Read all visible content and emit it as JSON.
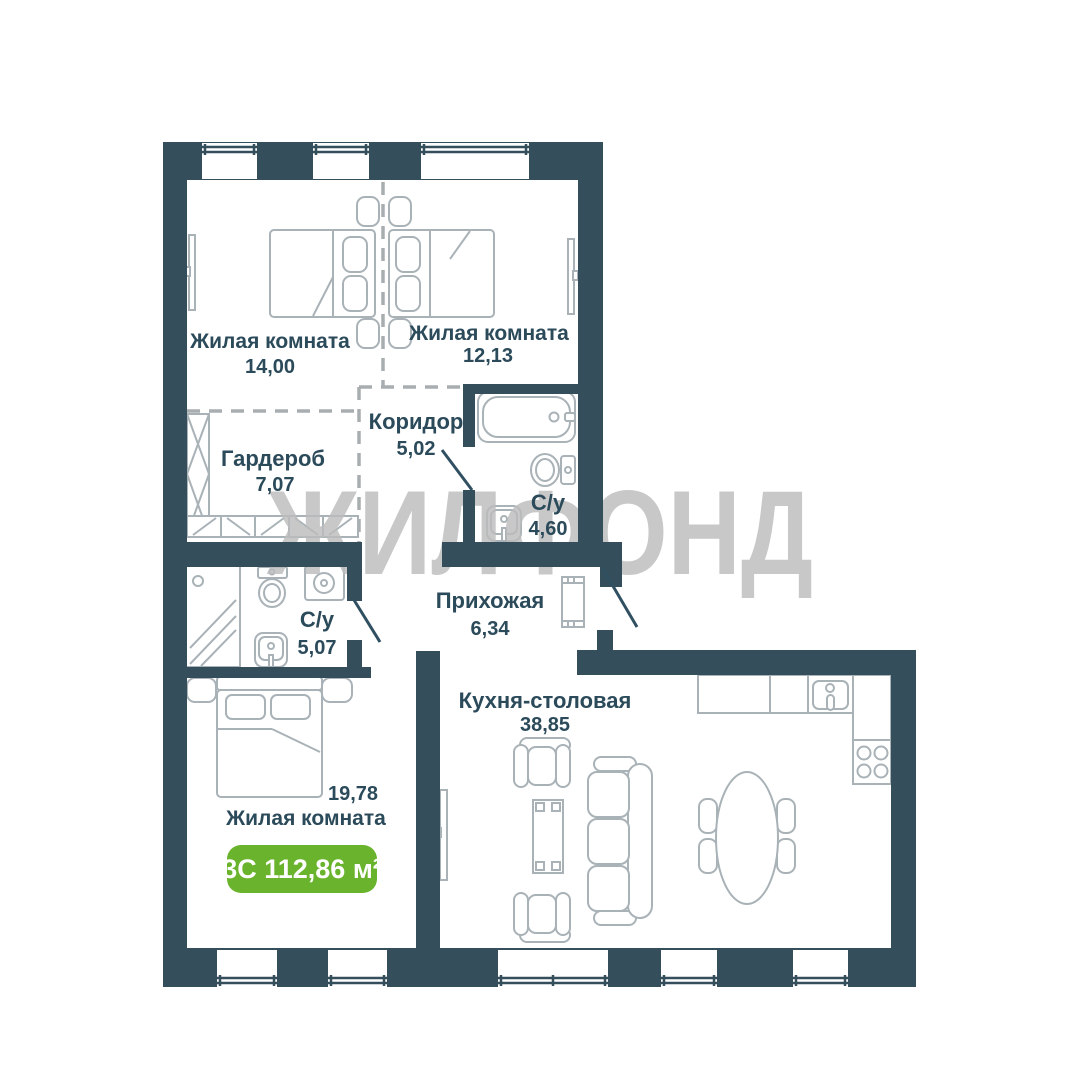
{
  "plan": {
    "watermark": "ЖИЛФОНД",
    "badge": {
      "label": "3С 112,86 м²",
      "color": "#6ab32d"
    },
    "rooms": [
      {
        "id": "living-room-1",
        "name": "Жилая комната",
        "area": "14,00"
      },
      {
        "id": "living-room-2",
        "name": "Жилая комната",
        "area": "12,13"
      },
      {
        "id": "corridor",
        "name": "Коридор",
        "area": "5,02"
      },
      {
        "id": "wardrobe",
        "name": "Гардероб",
        "area": "7,07"
      },
      {
        "id": "bathroom-1",
        "name": "С/у",
        "area": "4,60"
      },
      {
        "id": "bathroom-2",
        "name": "С/у",
        "area": "5,07"
      },
      {
        "id": "hallway",
        "name": "Прихожая",
        "area": "6,34"
      },
      {
        "id": "kitchen-dining",
        "name": "Кухня-столовая",
        "area": "38,85"
      },
      {
        "id": "living-room-3",
        "name": "Жилая комната",
        "area": "19,78"
      }
    ],
    "colors": {
      "wall": "#344f5b",
      "furniture_stroke": "#a9b2b7",
      "label": "#2b4a5a",
      "watermark": "#bcbcbc",
      "badge_green": "#6ab32d",
      "door_line": "#305061",
      "dashed_zone": "#a8adb0"
    }
  }
}
